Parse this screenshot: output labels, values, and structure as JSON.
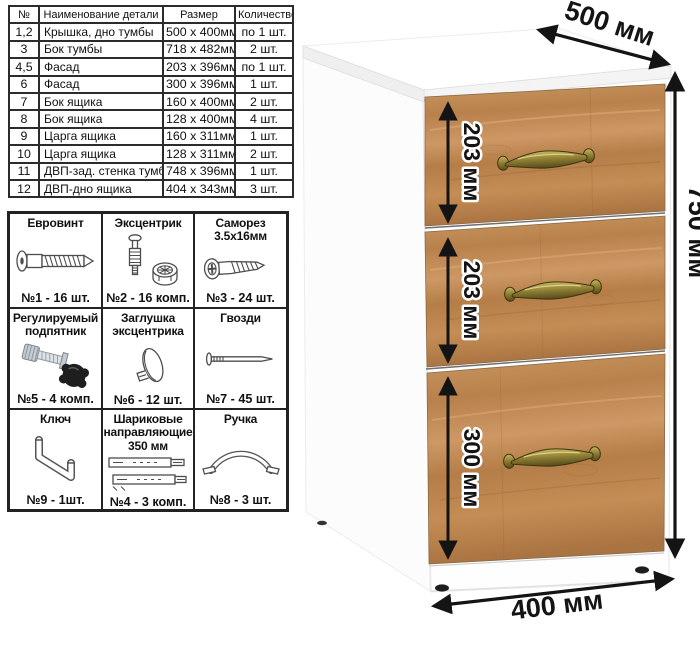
{
  "parts_table": {
    "headers": [
      "№",
      "Наименование детали",
      "Размер",
      "Количество"
    ],
    "rows": [
      [
        "1,2",
        "Крышка, дно тумбы",
        "500 x 400мм",
        "по 1 шт."
      ],
      [
        "3",
        "Бок тумбы",
        "718 x 482мм",
        "2 шт."
      ],
      [
        "4,5",
        "Фасад",
        "203 x 396мм",
        "по 1 шт."
      ],
      [
        "6",
        "Фасад",
        "300 x 396мм",
        "1 шт."
      ],
      [
        "7",
        "Бок ящика",
        "160 x 400мм",
        "2 шт."
      ],
      [
        "8",
        "Бок ящика",
        "128 x 400мм",
        "4 шт."
      ],
      [
        "9",
        "Царга ящика",
        "160 x 311мм",
        "1 шт."
      ],
      [
        "10",
        "Царга ящика",
        "128 x 311мм",
        "2 шт."
      ],
      [
        "11",
        "ДВП-зад. стенка тумбы",
        "748 x 396мм",
        "1 шт."
      ],
      [
        "12",
        "ДВП-дно ящика",
        "404 x 343мм",
        "3 шт."
      ]
    ]
  },
  "hardware_grid": {
    "items": [
      {
        "title": "Евровинт",
        "count": "№1 - 16 шт.",
        "icon": "euro-screw-icon"
      },
      {
        "title": "Эксцентрик",
        "count": "№2 - 16 комп.",
        "icon": "cam-lock-icon"
      },
      {
        "title": "Саморез 3.5х16мм",
        "count": "№3 - 24 шт.",
        "icon": "self-tapping-screw-icon"
      },
      {
        "title": "Регулируемый подпятник",
        "count": "№5 - 4 комп.",
        "icon": "adjustable-foot-icon"
      },
      {
        "title": "Заглушка эксцентрика",
        "count": "№6 - 12 шт.",
        "icon": "cam-cover-icon"
      },
      {
        "title": "Гвозди",
        "count": "№7 - 45 шт.",
        "icon": "nail-icon"
      },
      {
        "title": "Ключ",
        "count": "№9 - 1шт.",
        "icon": "hex-key-icon"
      },
      {
        "title": "Шариковые направляющие 350 мм",
        "count": "№4 - 3 комп.",
        "icon": "ball-bearing-slides-icon"
      },
      {
        "title": "Ручка",
        "count": "№8 - 3 шт.",
        "icon": "handle-icon"
      }
    ]
  },
  "cabinet": {
    "dimensions": {
      "depth": "500 мм",
      "height": "750 мм",
      "width": "400 мм",
      "drawer1": "203 мм",
      "drawer2": "203 мм",
      "drawer3": "300 мм"
    },
    "colors": {
      "wood": "#bf8a52",
      "body": "#ffffff",
      "handle_brass": "#8b7c32",
      "annotation": "#141414"
    }
  }
}
